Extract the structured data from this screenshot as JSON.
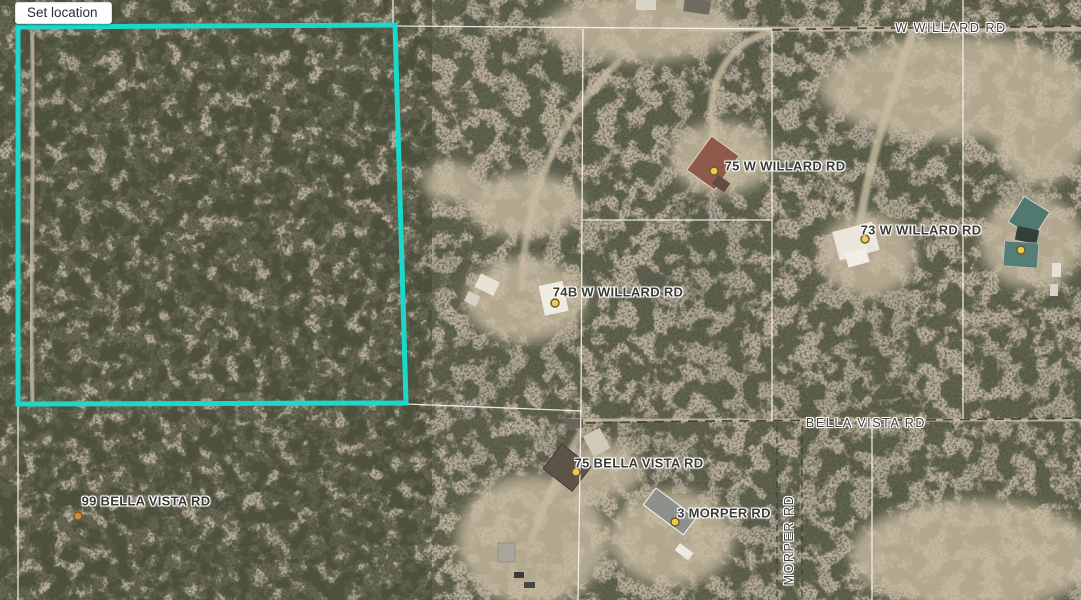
{
  "toolbar": {
    "set_location_label": "Set location"
  },
  "map": {
    "labels": {
      "w_willard_rd": "W WILLARD RD",
      "bella_vista_rd": "BELLA VISTA RD",
      "morper_rd": "MORPER RD",
      "addr_75_w_willard": "75 W WILLARD RD",
      "addr_73_w_willard": "73 W WILLARD RD",
      "addr_74b_w_willard": "74B W WILLARD RD",
      "addr_75_bella_vista": "75 BELLA VISTA RD",
      "addr_3_morper": "3 MORPER RD",
      "addr_99_bella_vista": "99 BELLA VISTA RD"
    },
    "colors": {
      "parcel_highlight": "#1bd8ca",
      "parcel_line": "#f8f5ec",
      "road_dash": "#3e3d37",
      "marker_fill": "#ecc94f",
      "marker_orange": "#cd8c3e"
    }
  }
}
